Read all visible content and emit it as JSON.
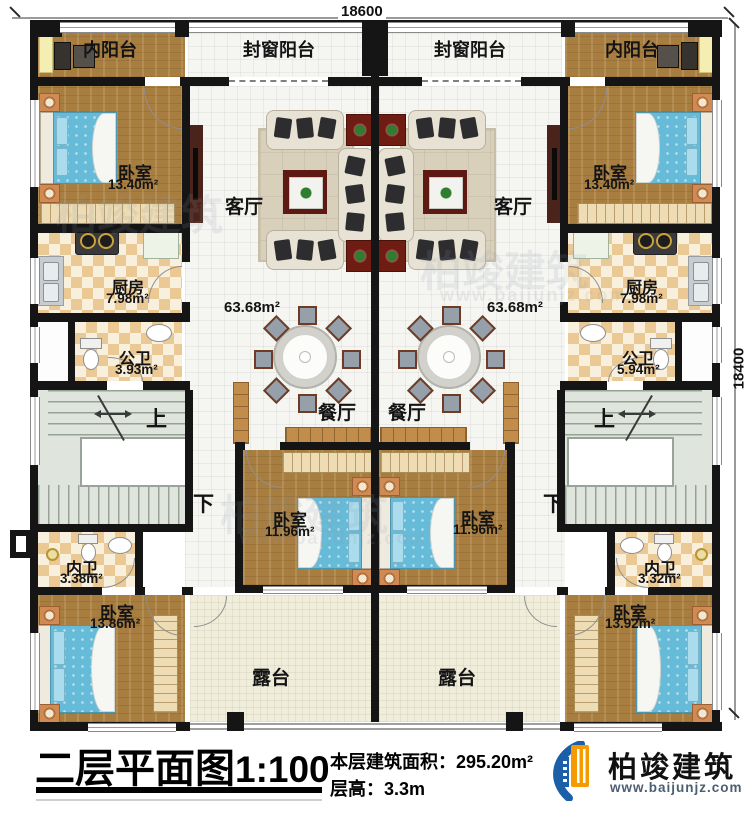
{
  "dims": {
    "top": "18600",
    "right": "18400"
  },
  "labels": {
    "inner_balcony_l": "内阳台",
    "sealed_balcony_l": "封窗阳台",
    "sealed_balcony_r": "封窗阳台",
    "inner_balcony_r": "内阳台",
    "bedroom_tl": "卧室",
    "bedroom_tl_area": "13.40m²",
    "bedroom_tr": "卧室",
    "bedroom_tr_area": "13.40m²",
    "living_l": "客厅",
    "living_l_area": "63.68m²",
    "living_r": "客厅",
    "living_r_area": "63.68m²",
    "kitchen_l": "厨房",
    "kitchen_l_area": "7.98m²",
    "kitchen_r": "厨房",
    "kitchen_r_area": "7.98m²",
    "bath_l": "公卫",
    "bath_l_area": "3.93m²",
    "bath_r": "公卫",
    "bath_r_area": "5.94m²",
    "dining_l": "餐厅",
    "dining_r": "餐厅",
    "up_l": "上",
    "up_r": "上",
    "down_l": "下",
    "down_r": "下",
    "bedroom_ml": "卧室",
    "bedroom_ml_area": "11.96m²",
    "bedroom_mr": "卧室",
    "bedroom_mr_area": "11.96m²",
    "ensuite_l": "内卫",
    "ensuite_l_area": "3.38m²",
    "ensuite_r": "内卫",
    "ensuite_r_area": "3.32m²",
    "bedroom_bl": "卧室",
    "bedroom_bl_area": "13.86m²",
    "bedroom_br": "卧室",
    "bedroom_br_area": "13.92m²",
    "terrace_l": "露台",
    "terrace_r": "露台"
  },
  "title_block": {
    "title": "二层平面图",
    "scale": "1:100",
    "area_label": "本层建筑面积：",
    "area_value": "295.20m²",
    "floor_height_label": "层高：",
    "floor_height_value": "3.3m"
  },
  "branding": {
    "company": "柏竣建筑",
    "website": "www.baijunjz.com"
  },
  "watermark": {
    "company": "柏竣建筑",
    "website": "www.baijunjz.com"
  },
  "colors": {
    "accent_blue": "#1b5fa8",
    "accent_orange": "#f59b00"
  }
}
